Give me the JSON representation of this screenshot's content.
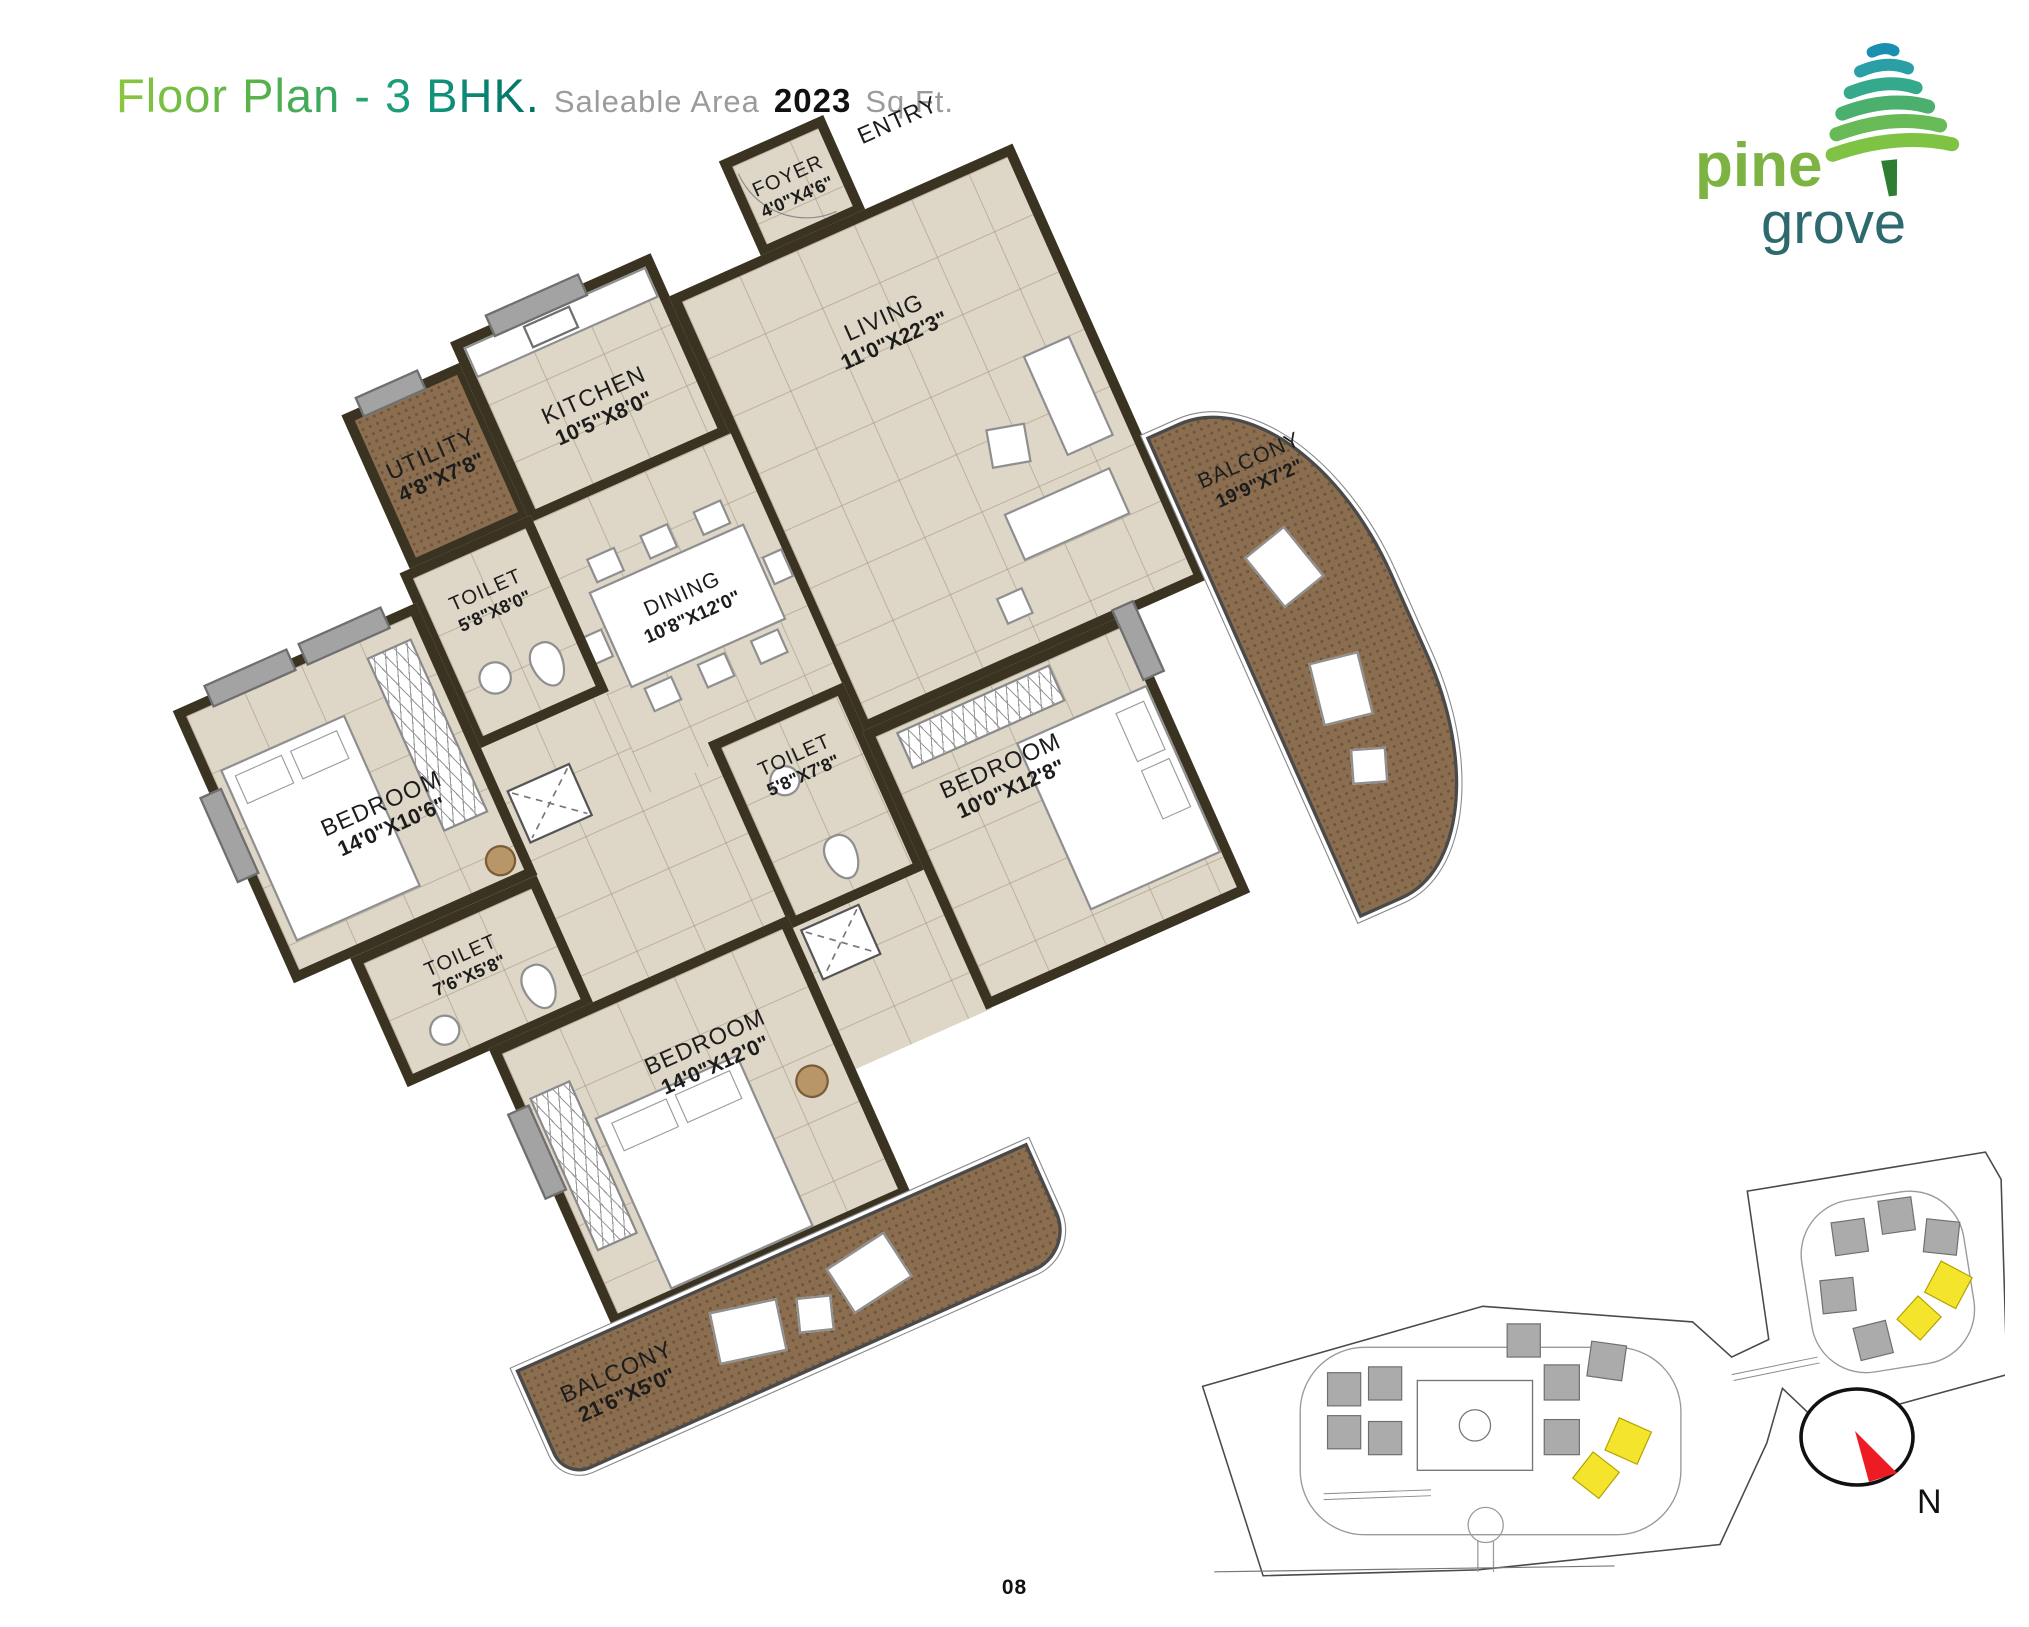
{
  "header": {
    "title_main": "Floor Plan - 3 BHK.",
    "subtitle_label": "Saleable Area",
    "area_value": "2023",
    "area_unit": "Sq Ft."
  },
  "logo": {
    "name_top": "pine",
    "name_bottom": "grove"
  },
  "plan": {
    "rooms": {
      "kitchen": {
        "name": "KITCHEN",
        "dims": "10'5\"X8'0\""
      },
      "utility": {
        "name": "UTILITY",
        "dims": "4'8\"X7'8\""
      },
      "foyer": {
        "name": "FOYER",
        "dims": "4'0\"X4'6\""
      },
      "entry": {
        "name": "ENTRY"
      },
      "living": {
        "name": "LIVING",
        "dims": "11'0\"X22'3\""
      },
      "dining": {
        "name": "DINING",
        "dims": "10'8\"X12'0\""
      },
      "toilet1": {
        "name": "TOILET",
        "dims": "5'8\"X8'0\""
      },
      "bedroom1": {
        "name": "BEDROOM",
        "dims": "14'0\"X10'6\""
      },
      "toilet2": {
        "name": "TOILET",
        "dims": "7'6\"X5'8\""
      },
      "toilet3": {
        "name": "TOILET",
        "dims": "5'8\"X7'8\""
      },
      "bedroom2": {
        "name": "BEDROOM",
        "dims": "10'0\"X12'8\""
      },
      "bedroom3": {
        "name": "BEDROOM",
        "dims": "14'0\"X12'0\""
      },
      "balcony1": {
        "name": "BALCONY",
        "dims": "21'6\"X5'0\""
      },
      "balcony2": {
        "name": "BALCONY",
        "dims": "19'9\"X7'2\""
      }
    }
  },
  "compass": {
    "north_label": "N"
  },
  "footer": {
    "page_number": "08"
  },
  "colors": {
    "wall": "#3a3322",
    "floor_tile": "#ded6c6",
    "balcony_tile": "#8b6e50",
    "brand_green": "#7cb342",
    "brand_teal": "#2d6a6e",
    "title_gradient_start": "#8cc63f",
    "title_gradient_end": "#006f63",
    "compass_red": "#ed1c24",
    "highlight_unit_yellow": "#f4e42b"
  }
}
